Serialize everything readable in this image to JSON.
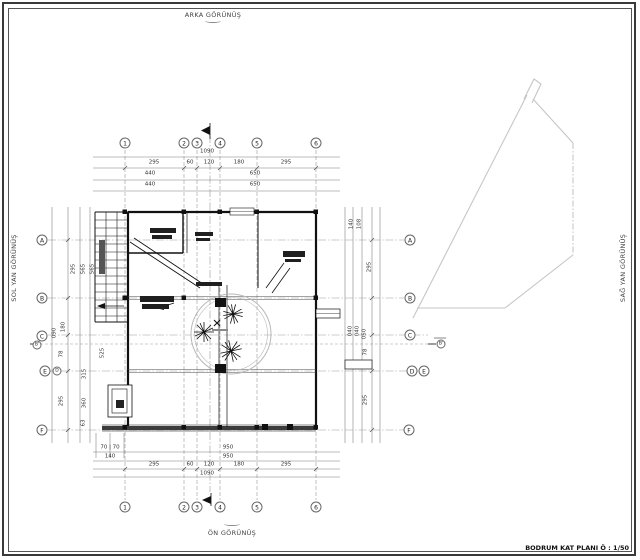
{
  "frame": {
    "title": "BODRUM KAT PLANI Ö : 1/50"
  },
  "edge_labels": {
    "top": "ARKA GÖRÜNÜŞ",
    "bottom": "ÖN GÖRÜNÜŞ",
    "left": "SOL YAN GÖRÜNÜŞ",
    "right": "SAĞ YAN GÖRÜNÜŞ"
  },
  "grid": {
    "cols": [
      "1",
      "2",
      "3",
      "4",
      "5",
      "6"
    ],
    "rows": [
      "A",
      "B",
      "C",
      "D",
      "E",
      "F"
    ],
    "row_b_prime": "B'"
  },
  "dims": {
    "top": [
      "1090",
      "295",
      "60",
      "120",
      "180",
      "295",
      "440",
      "650",
      "440",
      "650"
    ],
    "bottom": [
      "70 | 70",
      "140",
      "950",
      "950",
      "295",
      "60",
      "120",
      "180",
      "295",
      "1090"
    ],
    "left": [
      "295",
      "565",
      "565",
      "180",
      "090",
      "525",
      "78",
      "315",
      "295",
      "360",
      "63"
    ],
    "right": [
      "140",
      "108",
      "295",
      "040",
      "040",
      "050",
      "78",
      "295"
    ]
  },
  "colors": {
    "wall": "#111111",
    "grid_line": "#999999",
    "dim_line": "#777777",
    "site_boundary": "#c6c6c6",
    "text": "#333333"
  }
}
